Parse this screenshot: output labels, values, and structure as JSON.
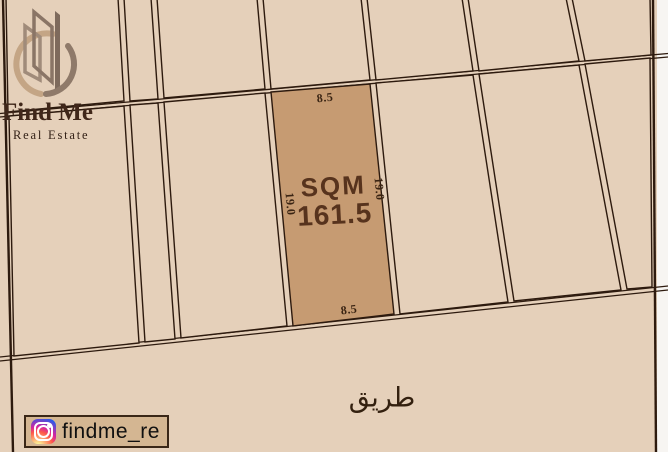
{
  "brand": {
    "name": "Find Me",
    "tagline": "Real Estate",
    "logo_icon": "building-circle-logo"
  },
  "parcel": {
    "area_label": "SQM",
    "area_value": "161.5",
    "width_top": "8.5",
    "width_bottom": "8.5",
    "depth_left": "19.0",
    "depth_right": "19.0"
  },
  "road": {
    "name": "طريق"
  },
  "social": {
    "icon": "instagram-icon",
    "handle": "findme_re"
  },
  "colors": {
    "map_background": "#e5d0ba",
    "parcel_highlight": "#c69b72",
    "boundary_line": "#2d1a0e",
    "outer_margin": "#f7f5f2",
    "badge_background": "#d4b692",
    "dim_text": "#3a2413",
    "area_text": "#57331d"
  }
}
